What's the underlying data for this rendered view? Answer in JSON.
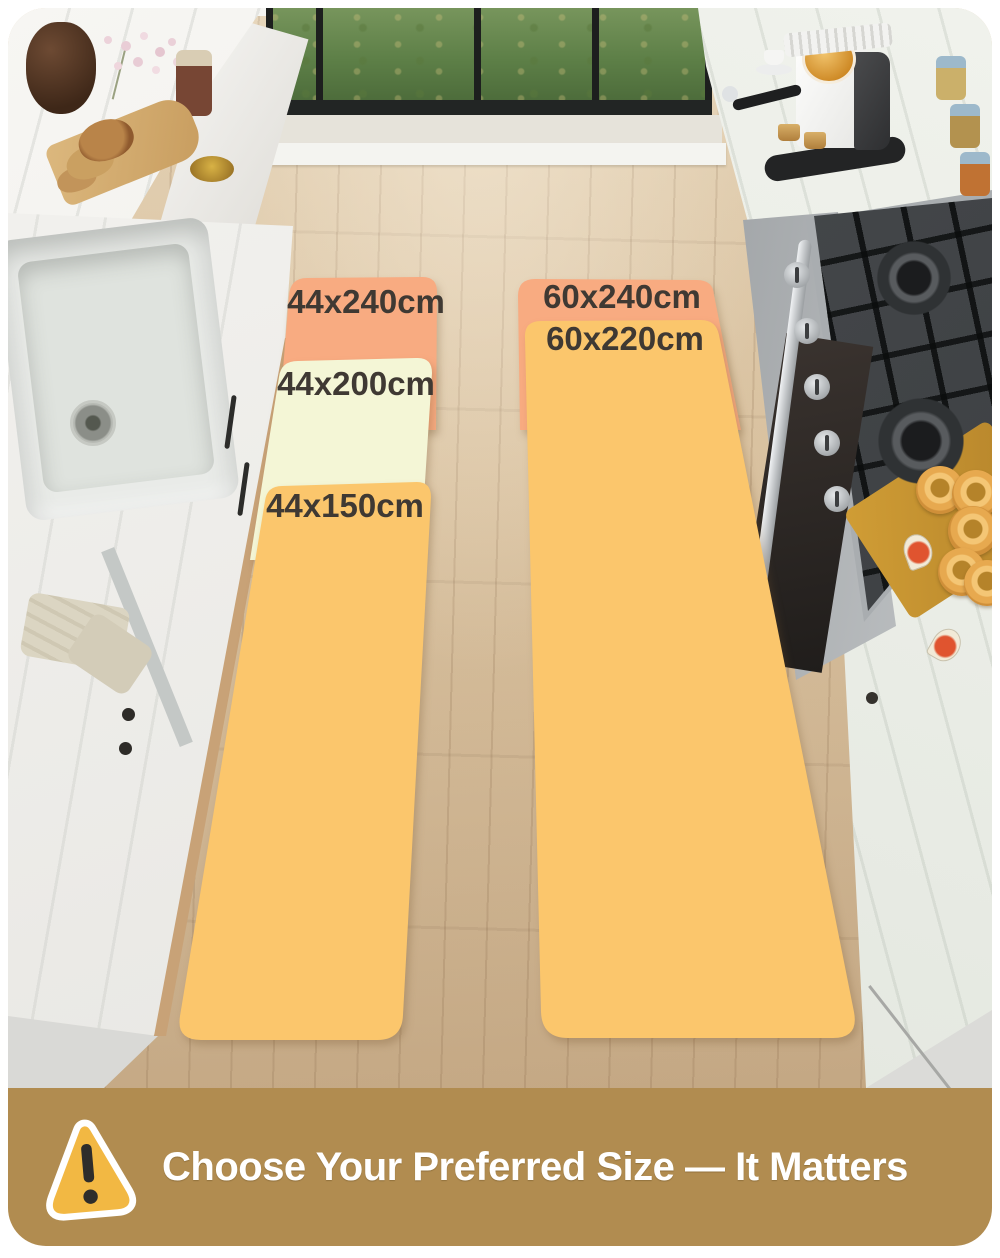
{
  "mats": {
    "left_runner": {
      "sections": [
        {
          "size_label": "44x240cm",
          "color": "#f8ab81"
        },
        {
          "size_label": "44x200cm",
          "color": "#f4f6d6"
        },
        {
          "size_label": "44x150cm",
          "color": "#fbc66c"
        }
      ]
    },
    "right_runner": {
      "sections": [
        {
          "size_label": "60x240cm",
          "color": "#f8ab81"
        },
        {
          "size_label": "60x220cm",
          "color": "#fbc66c"
        }
      ]
    },
    "label_text_color": "#3f3933"
  },
  "banner": {
    "title": "Choose Your Preferred Size — It Matters",
    "background_color": "#b18c50",
    "title_color": "#ffffff",
    "icon": {
      "name": "warning-triangle-icon",
      "fill": "#f2b843",
      "outline": "#ffffff",
      "mark_color": "#2e2d2b"
    }
  }
}
